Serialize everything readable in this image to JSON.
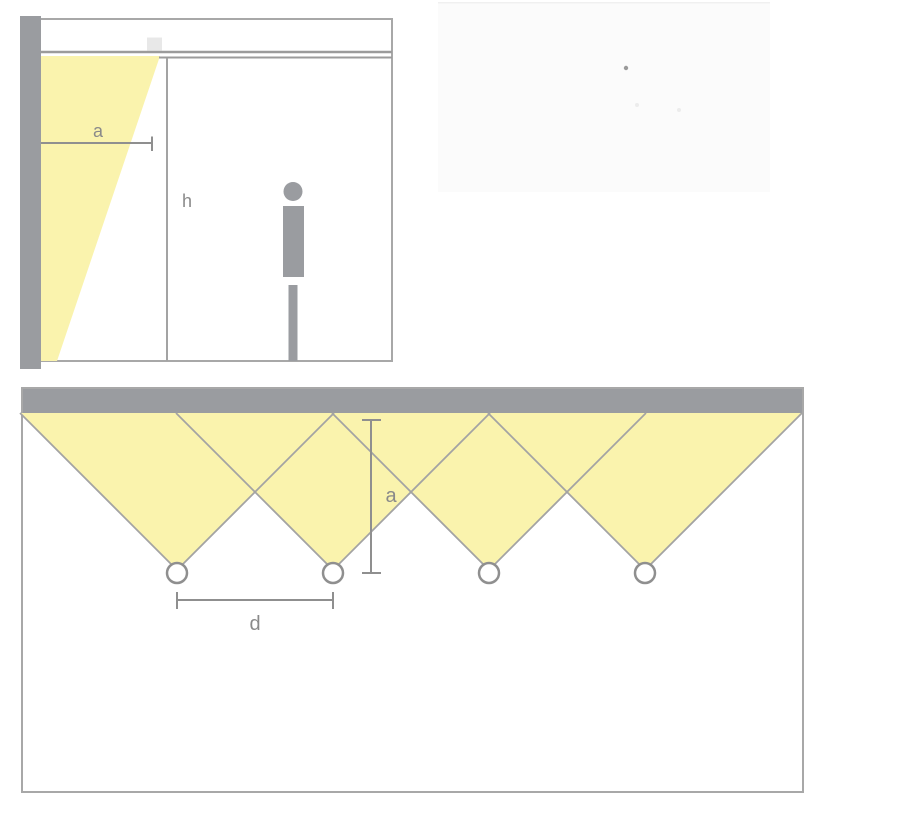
{
  "colors": {
    "beam_yellow": "#faf3ad",
    "wall_gray": "#9a9ca0",
    "outline_gray": "#a8a8a8",
    "ceiling_gray": "#9b9b9b",
    "edge_gray": "#a3a3a3",
    "dimension_gray": "#8f8f8f",
    "label_gray": "#8a8a8a",
    "fixture_gray": "#e8e8e8",
    "photo_background": "#fbfbfb",
    "white": "#ffffff"
  },
  "section_view": {
    "labels": {
      "setback": "a",
      "height": "h"
    }
  },
  "plan_view": {
    "labels": {
      "setback": "a",
      "spacing": "d"
    },
    "luminaire_count": 4
  }
}
